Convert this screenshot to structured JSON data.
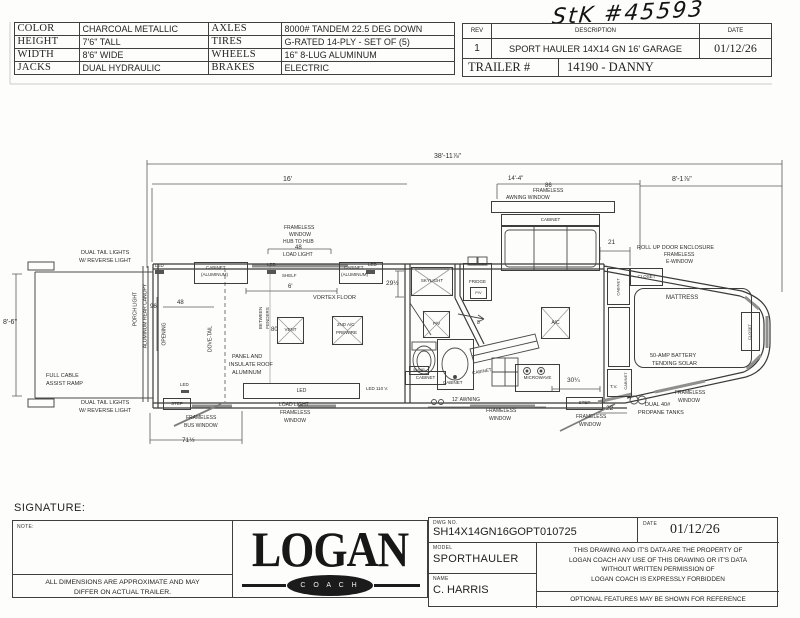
{
  "handwriting": {
    "stock_number": "StK #45593"
  },
  "spec_table": {
    "rows": [
      [
        "COLOR",
        "CHARCOAL METALLIC",
        "AXLES",
        "8000# TANDEM 22.5 DEG DOWN"
      ],
      [
        "HEIGHT",
        "7'6\" TALL",
        "TIRES",
        "G-RATED 14-PLY - SET OF (5)"
      ],
      [
        "WIDTH",
        "8'6\" WIDE",
        "WHEELS",
        "16\" 8-LUG ALUMINUM"
      ],
      [
        "JACKS",
        "DUAL HYDRAULIC",
        "BRAKES",
        "ELECTRIC"
      ]
    ]
  },
  "rev_table": {
    "rev_header": "REV",
    "description_header": "DESCRIPTION",
    "date_header": "DATE",
    "rev": "1",
    "description": "SPORT HAULER 14X14 GN 16' GARAGE",
    "date": "01/12/26",
    "trailer_label": "TRAILER #",
    "trailer_value": "14190 - DANNY"
  },
  "title_block": {
    "signature_label": "SIGNATURE:",
    "note_label": "NOTE:",
    "disclaimer": [
      "ALL DIMENSIONS ARE APPROXIMATE AND MAY",
      "DIFFER ON ACTUAL TRAILER."
    ],
    "logo_main": "LOGAN",
    "logo_sub": "C O A C H",
    "dwg_label": "DWG  NO.",
    "dwg_no": "SH14X14GN16GOPT010725",
    "date_label": "DATE",
    "date": "01/12/26",
    "model_label": "MODEL",
    "model": "SPORTHAULER",
    "name_label": "NAME",
    "name": "C. HARRIS",
    "legal": [
      "THIS DRAWING AND IT'S DATA ARE THE PROPERTY OF",
      "LOGAN COACH ANY USE OF THIS DRAWING OR IT'S DATA",
      "WITHOUT WRITTEN PERMISSION OF",
      "LOGAN COACH IS EXPRESSLY FORBIDDEN"
    ],
    "optional": "OPTIONAL FEATURES MAY BE SHOWN FOR REFERENCE"
  },
  "plan": {
    "labels": [
      {
        "n": "dim-overall-length",
        "t": "38'-11⅞\"",
        "x": 434,
        "y": 153,
        "s": 7
      },
      {
        "n": "dim-garage-16ft",
        "t": "16'",
        "x": 283,
        "y": 176,
        "s": 7
      },
      {
        "n": "dim-14-4",
        "t": "14'-4\"",
        "x": 508,
        "y": 176,
        "s": 6
      },
      {
        "n": "awning-86",
        "t": "86",
        "x": 545,
        "y": 183,
        "s": 6
      },
      {
        "n": "awning-frameless",
        "t": "FRAMELESS",
        "x": 533,
        "y": 189,
        "s": 5
      },
      {
        "n": "awning-window",
        "t": "AWNING  WINDOW",
        "x": 506,
        "y": 196,
        "s": 5
      },
      {
        "n": "dim-8-1",
        "t": "8'-1⅞\"",
        "x": 672,
        "y": 176,
        "s": 7
      },
      {
        "n": "dim-21",
        "t": "21",
        "x": 608,
        "y": 240,
        "s": 6.5
      },
      {
        "n": "rollup-line1",
        "t": "ROLL UP DOOR ENCLOSURE",
        "x": 637,
        "y": 246,
        "s": 5.5
      },
      {
        "n": "rollup-line2",
        "t": "FRAMELESS",
        "x": 664,
        "y": 253,
        "s": 5
      },
      {
        "n": "rollup-line3",
        "t": "E-WINDOW",
        "x": 666,
        "y": 260,
        "s": 5
      },
      {
        "n": "tail-lights-top-1",
        "t": "DUAL TAIL LIGHTS",
        "x": 81,
        "y": 251,
        "s": 5.5
      },
      {
        "n": "tail-lights-top-2",
        "t": "W/ REVERSE LIGHT",
        "x": 79,
        "y": 259,
        "s": 5.5
      },
      {
        "n": "dim-8-6",
        "t": "8'-6\"",
        "x": 3,
        "y": 319,
        "s": 7
      },
      {
        "n": "ramp-line1",
        "t": "FULL CABLE",
        "x": 46,
        "y": 374,
        "s": 5.5
      },
      {
        "n": "ramp-line2",
        "t": "ASSIST RAMP",
        "x": 46,
        "y": 382,
        "s": 5.5
      },
      {
        "n": "tail-lights-bottom-1",
        "t": "DUAL TAIL LIGHTS",
        "x": 81,
        "y": 401,
        "s": 5.5
      },
      {
        "n": "tail-lights-bottom-2",
        "t": "W/ REVERSE LIGHT",
        "x": 79,
        "y": 409,
        "s": 5.5
      },
      {
        "n": "porch-light",
        "t": "PORCH LIGHT",
        "x": 136,
        "y": 309,
        "s": 5,
        "r": -90
      },
      {
        "n": "aluminum-rear-canopy",
        "t": "ALUMINUM REAR CANOPY",
        "x": 146,
        "y": 316,
        "s": 5,
        "r": -90
      },
      {
        "n": "led-top-left",
        "t": "LED",
        "x": 155,
        "y": 264,
        "s": 4.5
      },
      {
        "n": "dim-96",
        "t": "96",
        "x": 150,
        "y": 304,
        "s": 6
      },
      {
        "n": "opening",
        "t": "OPENING",
        "x": 165,
        "y": 334,
        "s": 5,
        "r": -90
      },
      {
        "n": "dim-48-opening",
        "t": "48",
        "x": 177,
        "y": 300,
        "s": 6
      },
      {
        "n": "dove-tail",
        "t": "DOVE-TAIL",
        "x": 211,
        "y": 339,
        "s": 5,
        "r": -90
      },
      {
        "n": "cabinet-left-line1",
        "t": "CABINET",
        "x": 206,
        "y": 266,
        "s": 4.5
      },
      {
        "n": "cabinet-left-line2",
        "t": "(ALUMINUM)",
        "x": 201,
        "y": 273,
        "s": 4.5
      },
      {
        "n": "led-top-mid",
        "t": "LED",
        "x": 267,
        "y": 263,
        "s": 4.5
      },
      {
        "n": "shelf",
        "t": "SHELF",
        "x": 282,
        "y": 274,
        "s": 4.5
      },
      {
        "n": "dim-6ft",
        "t": "6'",
        "x": 288,
        "y": 284,
        "s": 6
      },
      {
        "n": "cabinet-right-line1",
        "t": "CABINET",
        "x": 344,
        "y": 266,
        "s": 4.5
      },
      {
        "n": "led-top-right",
        "t": "LED",
        "x": 368,
        "y": 263,
        "s": 4.5
      },
      {
        "n": "cabinet-right-line2",
        "t": "(ALUMINUM)",
        "x": 341,
        "y": 273,
        "s": 4.5
      },
      {
        "n": "dim-29-half",
        "t": "29½",
        "x": 386,
        "y": 281,
        "s": 6.5
      },
      {
        "n": "hub-window-1",
        "t": "FRAMELESS",
        "x": 284,
        "y": 226,
        "s": 5
      },
      {
        "n": "hub-window-2",
        "t": "WINDOW",
        "x": 289,
        "y": 233,
        "s": 5
      },
      {
        "n": "hub-window-3",
        "t": "HUB TO HUB",
        "x": 283,
        "y": 240,
        "s": 5
      },
      {
        "n": "dim-48-hub",
        "t": "48",
        "x": 295,
        "y": 245,
        "s": 6
      },
      {
        "n": "hub-load-light",
        "t": "LOAD LIGHT",
        "x": 283,
        "y": 253,
        "s": 5
      },
      {
        "n": "vortex-floor",
        "t": "VORTEX FLOOR",
        "x": 313,
        "y": 296,
        "s": 5.5
      },
      {
        "n": "between",
        "t": "BETWEEN",
        "x": 261,
        "y": 318,
        "s": 4.5,
        "r": -90
      },
      {
        "n": "fenders",
        "t": "FENDERS",
        "x": 268,
        "y": 318,
        "s": 4.5,
        "r": -90
      },
      {
        "n": "dim-80",
        "t": "80",
        "x": 271,
        "y": 327,
        "s": 6
      },
      {
        "n": "prewire-line1",
        "t": "2ND A/C",
        "x": 337,
        "y": 323,
        "s": 4.5
      },
      {
        "n": "prewire-line2",
        "t": "PREWIRE",
        "x": 336,
        "y": 331,
        "s": 4.5
      },
      {
        "n": "roof-line1",
        "t": "PANEL AND",
        "x": 232,
        "y": 355,
        "s": 5.5
      },
      {
        "n": "roof-line2",
        "t": "INSULATE ROOF",
        "x": 229,
        "y": 363,
        "s": 5.5
      },
      {
        "n": "roof-line3",
        "t": "ALUMINUM",
        "x": 232,
        "y": 371,
        "s": 5.5
      },
      {
        "n": "led-110v",
        "t": "LED 110 V.",
        "x": 366,
        "y": 387,
        "s": 4.5
      },
      {
        "n": "led-bottom-left",
        "t": "LED",
        "x": 180,
        "y": 383,
        "s": 4.5
      },
      {
        "n": "bus-window-1",
        "t": "FRAMELESS",
        "x": 186,
        "y": 416,
        "s": 5
      },
      {
        "n": "bus-window-2",
        "t": "BUS WINDOW",
        "x": 184,
        "y": 424,
        "s": 5
      },
      {
        "n": "dim-71-half",
        "t": "71½",
        "x": 182,
        "y": 438,
        "s": 6.5
      },
      {
        "n": "load-light-win-1",
        "t": "LOAD LIGHT",
        "x": 279,
        "y": 403,
        "s": 5
      },
      {
        "n": "load-light-win-2",
        "t": "FRAMELESS",
        "x": 280,
        "y": 411,
        "s": 5
      },
      {
        "n": "load-light-win-3",
        "t": "WINDOW",
        "x": 284,
        "y": 419,
        "s": 5
      },
      {
        "n": "door-8",
        "t": "8",
        "x": 477,
        "y": 321,
        "s": 5
      },
      {
        "n": "sink-cabinet-label",
        "t": "CABINET",
        "x": 443,
        "y": 381,
        "s": 4.5
      },
      {
        "n": "counter-cabinet-label",
        "t": "CABINET",
        "x": 482,
        "y": 372,
        "s": 4.5,
        "r": -10
      },
      {
        "n": "awning-12ft",
        "t": "12' AWNING",
        "x": 452,
        "y": 398,
        "s": 5
      },
      {
        "n": "frameless-window-mid-1",
        "t": "FRAMELESS",
        "x": 486,
        "y": 409,
        "s": 5
      },
      {
        "n": "frameless-window-mid-2",
        "t": "WINDOW",
        "x": 489,
        "y": 417,
        "s": 5
      },
      {
        "n": "dim-30-quarter",
        "t": "30¼",
        "x": 567,
        "y": 378,
        "s": 6.5
      },
      {
        "n": "frameless-window-step-1",
        "t": "FRAMELESS",
        "x": 576,
        "y": 415,
        "s": 5
      },
      {
        "n": "frameless-window-step-2",
        "t": "WINDOW",
        "x": 579,
        "y": 423,
        "s": 5
      },
      {
        "n": "dim-22",
        "t": "22",
        "x": 606,
        "y": 406,
        "s": 6.5
      },
      {
        "n": "propane-line1",
        "t": "DUAL 40#",
        "x": 645,
        "y": 403,
        "s": 5.5
      },
      {
        "n": "propane-line2",
        "t": "PROPANE TANKS",
        "x": 638,
        "y": 411,
        "s": 5.5
      },
      {
        "n": "tv-label",
        "t": "T.V.",
        "x": 610,
        "y": 385,
        "s": 4.5
      },
      {
        "n": "tv-cabinet-label",
        "t": "CABINET",
        "x": 626,
        "y": 381,
        "s": 4,
        "r": -90
      },
      {
        "n": "mattress-label",
        "t": "MATTRESS",
        "x": 666,
        "y": 295,
        "s": 6
      },
      {
        "n": "solar-line1",
        "t": "50-AMP BATTERY",
        "x": 650,
        "y": 354,
        "s": 5.5
      },
      {
        "n": "solar-line2",
        "t": "TENDING SOLAR",
        "x": 652,
        "y": 362,
        "s": 5.5
      },
      {
        "n": "frameless-window-bed-1",
        "t": "FRAMELESS",
        "x": 675,
        "y": 391,
        "s": 5
      },
      {
        "n": "frameless-window-bed-2",
        "t": "WINDOW",
        "x": 678,
        "y": 399,
        "s": 5
      }
    ],
    "boxes": [
      {
        "n": "cabinet-aluminum-left",
        "x": 194,
        "y": 262,
        "w": 54,
        "h": 22
      },
      {
        "n": "cabinet-aluminum-right",
        "x": 339,
        "y": 262,
        "w": 44,
        "h": 22
      },
      {
        "n": "vent",
        "x": 277,
        "y": 317,
        "w": 27,
        "h": 27,
        "t": "VENT",
        "s": 4.5
      },
      {
        "n": "second-ac-prewire",
        "x": 332,
        "y": 316,
        "w": 31,
        "h": 29
      },
      {
        "n": "led-bar",
        "x": 243,
        "y": 383,
        "w": 117,
        "h": 16,
        "t": "LED",
        "s": 5
      },
      {
        "n": "step-left",
        "x": 163,
        "y": 398,
        "w": 28,
        "h": 12,
        "t": "STEP",
        "s": 4.5
      },
      {
        "n": "skylight",
        "x": 411,
        "y": 267,
        "w": 42,
        "h": 29,
        "t": "SKYLIGHT",
        "s": 4.5
      },
      {
        "n": "fridge",
        "x": 463,
        "y": 263,
        "w": 29,
        "h": 38,
        "t": "FRIDGE",
        "s": 4.5
      },
      {
        "n": "fridge-pv",
        "x": 470,
        "y": 287,
        "w": 17,
        "h": 12,
        "t": "P/V",
        "s": 4
      },
      {
        "n": "bath-pv",
        "x": 423,
        "y": 311,
        "w": 27,
        "h": 27,
        "t": "P/V",
        "s": 4.5
      },
      {
        "n": "toilet-cabinet-small",
        "x": 409,
        "y": 366,
        "w": 20,
        "h": 9,
        "t": "50AMP",
        "s": 3.5
      },
      {
        "n": "toilet-cabinet",
        "x": 405,
        "y": 371,
        "w": 41,
        "h": 14,
        "t": "CABINET",
        "s": 4.5
      },
      {
        "n": "sink-cabinet",
        "x": 437,
        "y": 339,
        "w": 37,
        "h": 51
      },
      {
        "n": "microwave",
        "x": 515,
        "y": 364,
        "w": 45,
        "h": 28,
        "t": "MICROWAVE",
        "s": 4.5
      },
      {
        "n": "ac-unit",
        "x": 541,
        "y": 307,
        "w": 29,
        "h": 32,
        "t": "A/C",
        "s": 5
      },
      {
        "n": "step-right",
        "x": 566,
        "y": 397,
        "w": 37,
        "h": 13,
        "t": "STEP",
        "s": 4.5
      },
      {
        "n": "closet-top",
        "x": 630,
        "y": 268,
        "w": 33,
        "h": 18,
        "t": "CLOSET",
        "s": 4.5
      },
      {
        "n": "bedroom-cabinet",
        "x": 607,
        "y": 268,
        "w": 23,
        "h": 37,
        "t": "CABINET",
        "s": 4,
        "rot": true
      },
      {
        "n": "bedroom-bench",
        "x": 608,
        "y": 307,
        "w": 22,
        "h": 60
      },
      {
        "n": "tv-cabinet",
        "x": 607,
        "y": 369,
        "w": 25,
        "h": 28
      },
      {
        "n": "mattress",
        "x": 634,
        "y": 288,
        "w": 118,
        "h": 80,
        "rad": 10
      },
      {
        "n": "closet-right",
        "x": 741,
        "y": 312,
        "w": 19,
        "h": 39,
        "t": "CLOSET",
        "s": 4,
        "rot": true
      },
      {
        "n": "gooseneck-awning-bar",
        "x": 491,
        "y": 201,
        "w": 124,
        "h": 12
      },
      {
        "n": "gooseneck-cabinet",
        "x": 501,
        "y": 214,
        "w": 99,
        "h": 12,
        "t": "CABINET",
        "s": 4.5
      },
      {
        "n": "gooseneck-window",
        "x": 501,
        "y": 226,
        "w": 99,
        "h": 45
      }
    ]
  }
}
